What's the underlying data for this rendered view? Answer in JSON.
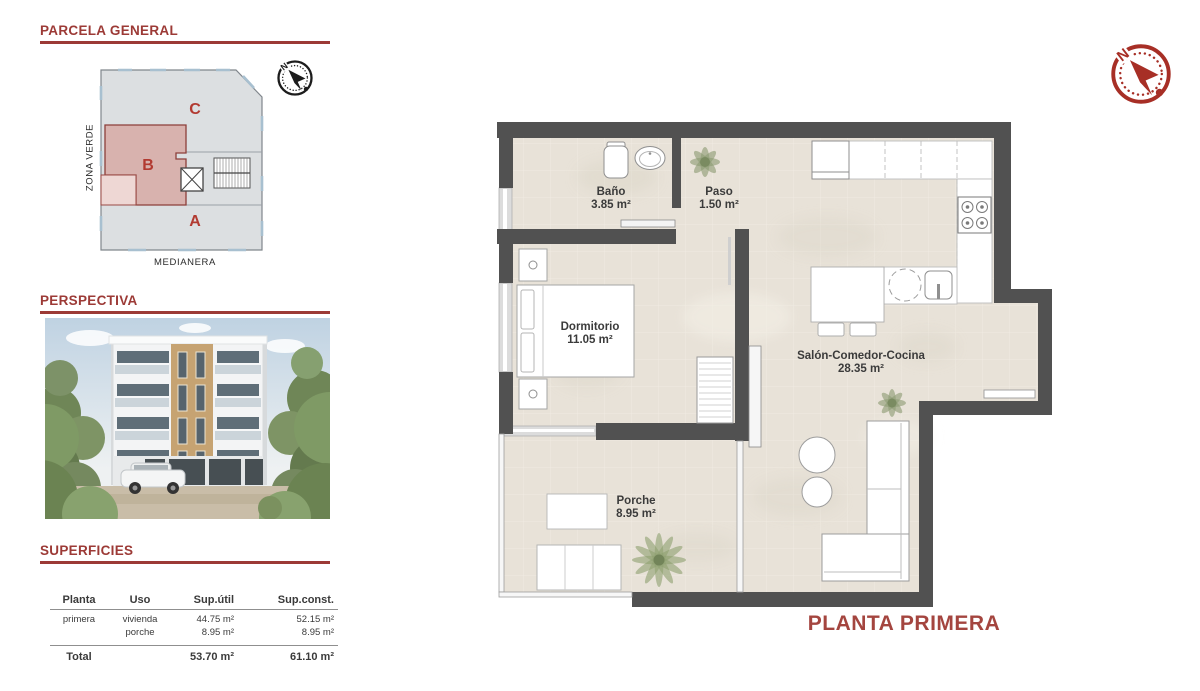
{
  "parcela": {
    "title": "PARCELA GENERAL",
    "zone_a": "A",
    "zone_b": "B",
    "zone_c": "C",
    "side_label": "ZONA VERDE",
    "bottom_label": "MEDIANERA",
    "compass_north": "N"
  },
  "perspectiva": {
    "title": "PERSPECTIVA"
  },
  "superficies": {
    "title": "SUPERFICIES",
    "headers": [
      "Planta",
      "Uso",
      "Sup.útil",
      "Sup.const."
    ],
    "row": {
      "planta": "primera",
      "uso": [
        "vivienda",
        "porche"
      ],
      "sup_util": [
        "44.75 m²",
        "8.95 m²"
      ],
      "sup_const": [
        "52.15 m²",
        "8.95 m²"
      ]
    },
    "total": {
      "label": "Total",
      "sup_util": "53.70 m²",
      "sup_const": "61.10 m²"
    }
  },
  "floorplan": {
    "title": "PLANTA PRIMERA",
    "compass_north": "N",
    "rooms": {
      "bano": {
        "name": "Baño",
        "area": "3.85 m²"
      },
      "paso": {
        "name": "Paso",
        "area": "1.50 m²"
      },
      "dormitorio": {
        "name": "Dormitorio",
        "area": "11.05 m²"
      },
      "salon": {
        "name": "Salón-Comedor-Cocina",
        "area": "28.35 m²"
      },
      "porche": {
        "name": "Porche",
        "area": "8.95 m²"
      }
    }
  },
  "colors": {
    "accent": "#9c3a36",
    "wall": "#515151",
    "floor": "#e8e2d8",
    "plan_title": "#a4453f",
    "zone_b_fill": "#d8b2ae"
  }
}
